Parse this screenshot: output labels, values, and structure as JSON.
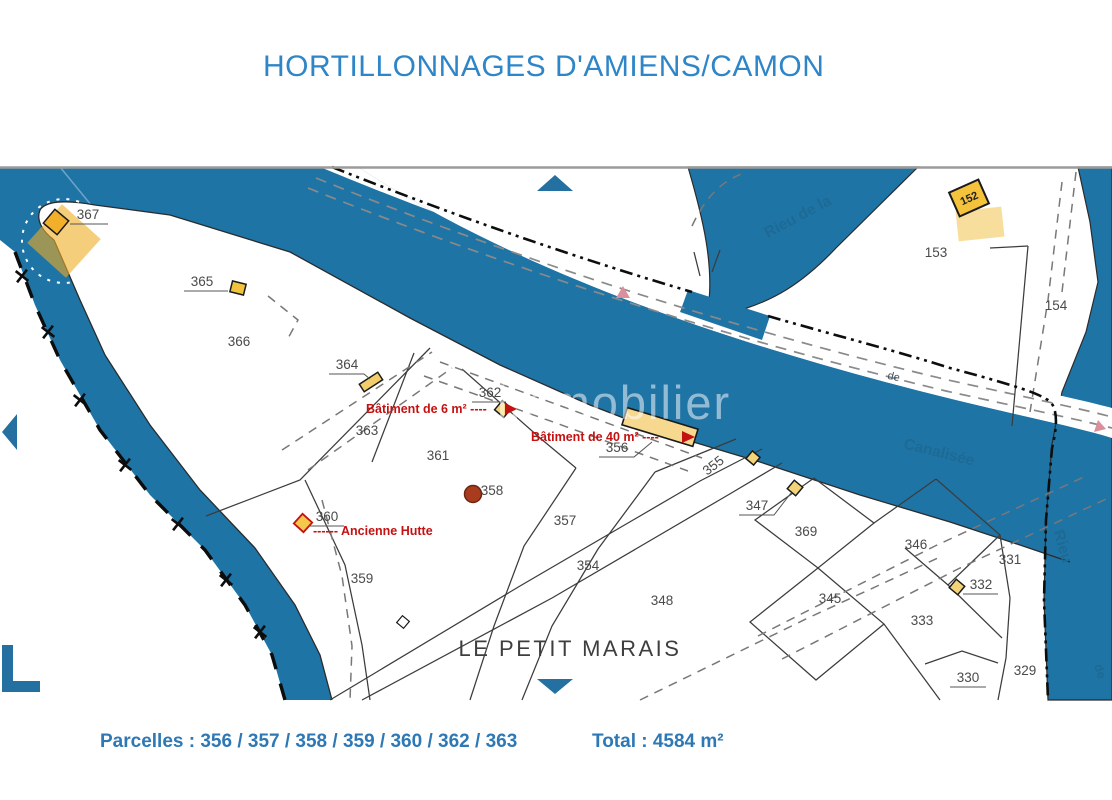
{
  "title": "HORTILLONNAGES D'AMIENS/CAMON",
  "footer": {
    "parcelles_label": "Parcelles : 356 / 357 / 358 / 359 / 360 / 362 / 363",
    "total_label": "Total : 4584 m²"
  },
  "colors": {
    "water_blue": "#1f74a6",
    "accent_blue": "#2e86c8",
    "annotation_red": "#c41111",
    "building_yellow": "#f5c84c",
    "building_pale": "#f4d478",
    "boundary_black": "#111111"
  },
  "map": {
    "place_label": "LE PETIT MARAIS",
    "watermark": "immobilier",
    "building_152": "152",
    "water_labels": {
      "rieu_de_la": "Rieu de la",
      "canalisee": "Canalisée",
      "de_towpath": "de",
      "rieu_right": "Rieu",
      "de_right": "de"
    },
    "annotations": {
      "batiment6": "Bâtiment de 6 m² ----",
      "batiment40": "Bâtiment de 40 m² ----",
      "hutte": "------ Ancienne Hutte"
    },
    "parcels": [
      {
        "label": "367"
      },
      {
        "label": "365"
      },
      {
        "label": "366"
      },
      {
        "label": "364"
      },
      {
        "label": "362"
      },
      {
        "label": "363"
      },
      {
        "label": "361"
      },
      {
        "label": "356"
      },
      {
        "label": "358"
      },
      {
        "label": "357"
      },
      {
        "label": "360"
      },
      {
        "label": "359"
      },
      {
        "label": "355"
      },
      {
        "label": "354"
      },
      {
        "label": "348"
      },
      {
        "label": "347"
      },
      {
        "label": "369"
      },
      {
        "label": "346"
      },
      {
        "label": "345"
      },
      {
        "label": "331"
      },
      {
        "label": "332"
      },
      {
        "label": "333"
      },
      {
        "label": "330"
      },
      {
        "label": "329"
      },
      {
        "label": "153"
      },
      {
        "label": "154"
      }
    ]
  }
}
